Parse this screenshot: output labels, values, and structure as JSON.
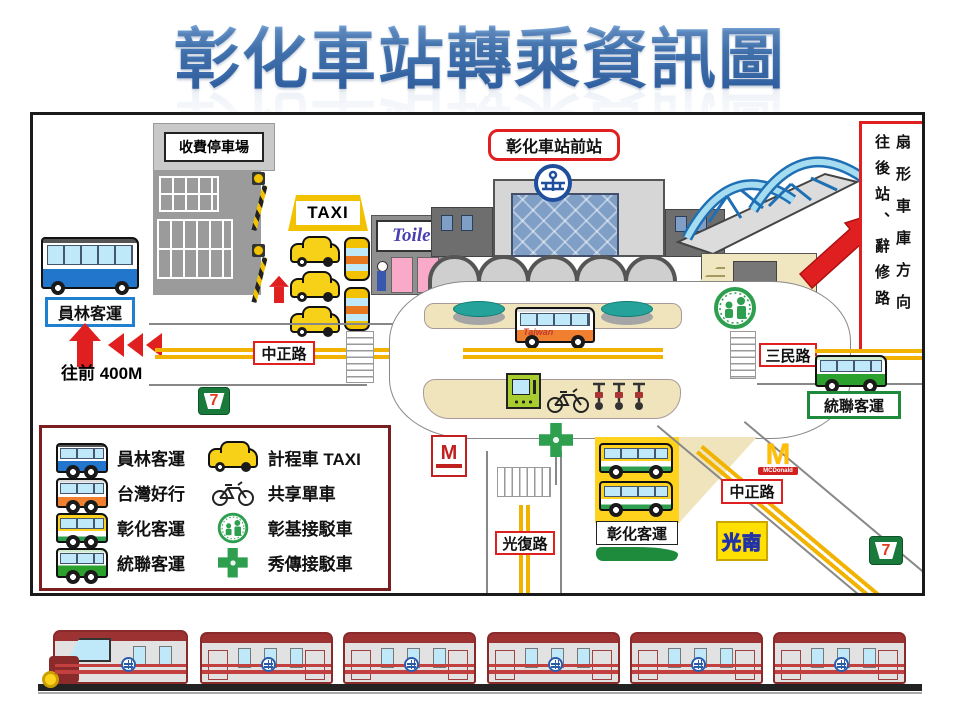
{
  "title": "彰化車站轉乘資訊圖",
  "colors": {
    "title_blue": "#4a7ebb",
    "accent_red": "#e02020",
    "road_yellow": "#f2b300",
    "island_tan": "#efe4bb",
    "legend_border": "#7a1f1f",
    "brand_green": "#2e9e4f",
    "taxi_yellow": "#f7d117",
    "train_red": "#9c3232",
    "bridge_blue": "#9fd5ec",
    "tra_blue": "#1f4e9c"
  },
  "map": {
    "parking_sign": "收費停車場",
    "taxi_sign": "TAXI",
    "toilet_sign": "Toilet",
    "station_front_sign": "彰化車站前站",
    "direction_sign": {
      "col_rear": "往後站、辭修路",
      "col_depot": "扇形車庫方向"
    },
    "yuanlin_stop": "員林客運",
    "walk_hint": "往前 400M",
    "road_zhongzheng_west": "中正路",
    "road_sanmin": "三民路",
    "tonglian_stop": "統聯客運",
    "road_guangfu": "光復路",
    "road_zhongzheng_south": "中正路",
    "changhua_bus_terminal": "彰化客運",
    "kuangnan_store": "光南",
    "mcdonalds_m": "M",
    "mcdonalds_text": "MCDonald",
    "mos_m": "M",
    "seven_eleven_text": "7",
    "taiwan_bus_text": "Taiwan"
  },
  "legend": {
    "items": [
      {
        "icon": "yuanlin-bus-icon",
        "label": "員林客運"
      },
      {
        "icon": "taiwan-trip-bus-icon",
        "label": "台灣好行"
      },
      {
        "icon": "changhua-bus-icon",
        "label": "彰化客運"
      },
      {
        "icon": "tonglian-bus-icon",
        "label": "統聯客運"
      },
      {
        "icon": "taxi-icon",
        "label": "計程車 TAXI"
      },
      {
        "icon": "shared-bike-icon",
        "label": "共享單車"
      },
      {
        "icon": "cch-shuttle-icon",
        "label": "彰基接駁車"
      },
      {
        "icon": "showchwan-shuttle-icon",
        "label": "秀傳接駁車"
      }
    ]
  }
}
